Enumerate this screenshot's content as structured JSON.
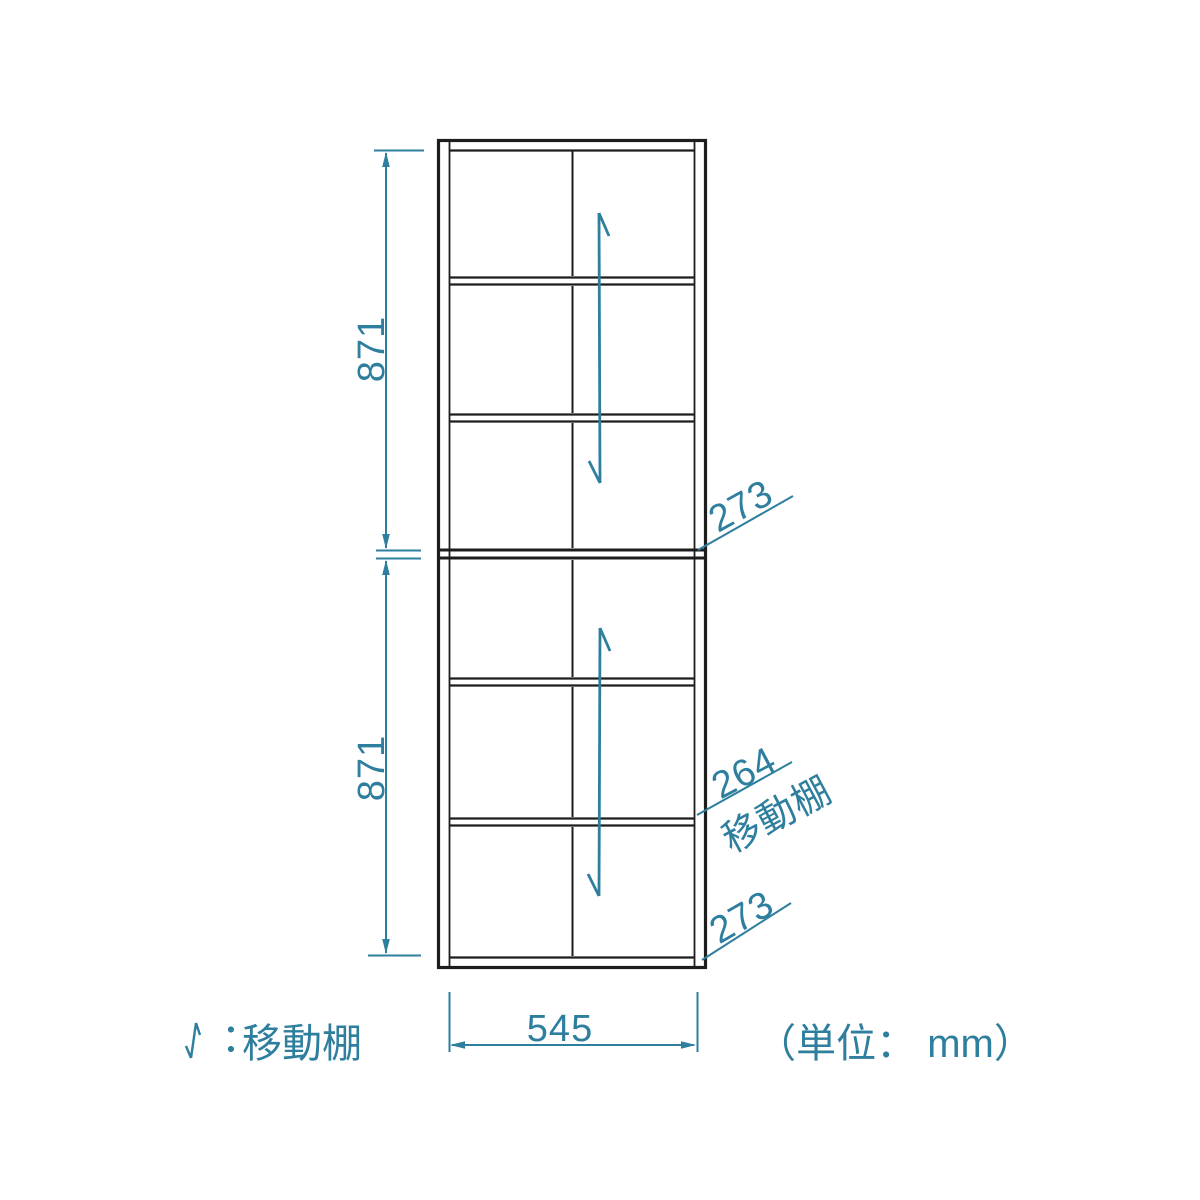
{
  "colors": {
    "outline": "#1d1d1d",
    "dimension": "#2e7e9e",
    "background": "#ffffff"
  },
  "labels": {
    "upper_height": "871",
    "lower_height": "871",
    "width": "545",
    "upper_section_pitch": "273",
    "movable_shelf_value": "264",
    "movable_shelf_text": "移動棚",
    "lower_section_pitch": "273",
    "legend_text": "︓移動棚",
    "unit_text": "（単位： mm）"
  }
}
